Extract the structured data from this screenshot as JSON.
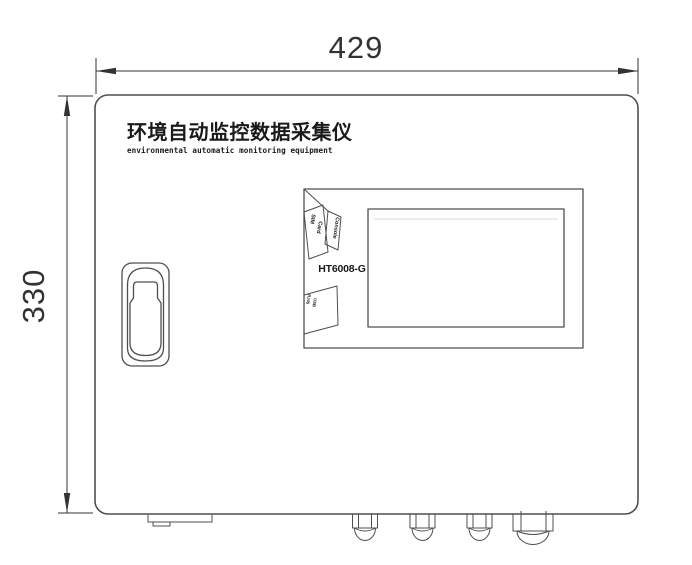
{
  "dimensions": {
    "width_label": "429",
    "height_label": "330"
  },
  "titles": {
    "cn": "环境自动监控数据采集仪",
    "en": "environmental automatic monitoring equipment"
  },
  "model": "HT6008-G",
  "port_labels": {
    "console": "Console",
    "sim_line1": "SIM",
    "sim_line2": "Card",
    "io_line1": "RJ45",
    "io_line2": "USB"
  },
  "colors": {
    "background": "#ffffff",
    "line": "#4f4f4f",
    "dimension": "#333333",
    "text": "#1a1a1a",
    "screen_highlight": "#d9d9d9"
  }
}
